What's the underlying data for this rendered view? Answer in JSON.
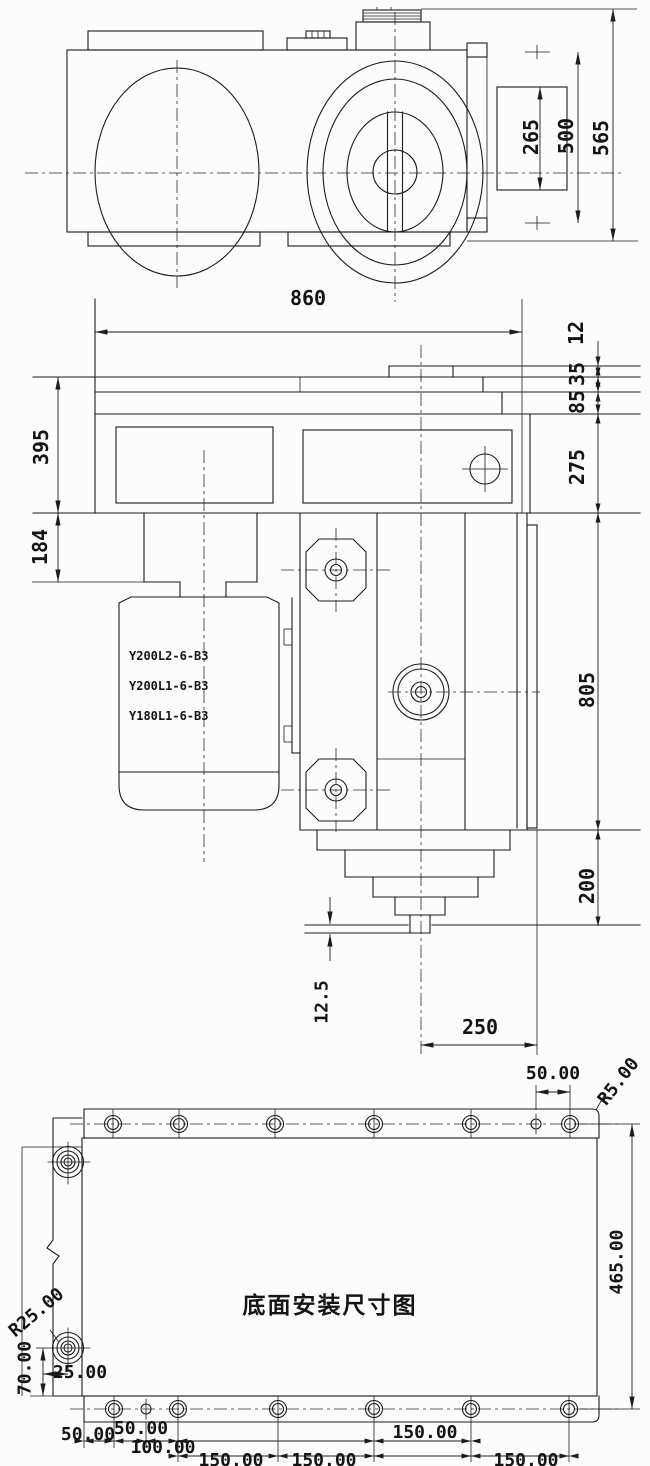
{
  "drawing": {
    "background": "#fcfcfc",
    "line_color": "#1c1c1c",
    "views": {
      "top": {
        "dims": {
          "d265": "265",
          "d500": "500",
          "d565": "565"
        }
      },
      "side": {
        "dims": {
          "d860": "860",
          "d12": "12",
          "d35": "35",
          "d85": "85",
          "d275": "275",
          "d395": "395",
          "d184": "184",
          "d805": "805",
          "d200": "200",
          "d12_5": "12.5",
          "d250": "250"
        },
        "motor_models": [
          "Y200L2-6-B3",
          "Y200L1-6-B3",
          "Y180L1-6-B3"
        ]
      },
      "bottom": {
        "title": "底面安装尺寸图",
        "dims": {
          "top_50": "50.00",
          "r5": "R5.00",
          "right_465": "465.00",
          "r25": "R25.00",
          "left_70": "70.00",
          "left_25": "25.00",
          "b50_edge": "50.00",
          "b50_hole": "50.00",
          "b100": "100.00",
          "b150_1": "150.00",
          "b150_2": "150.00",
          "b150_3": "150.00",
          "b150_4": "150.00"
        }
      }
    }
  }
}
